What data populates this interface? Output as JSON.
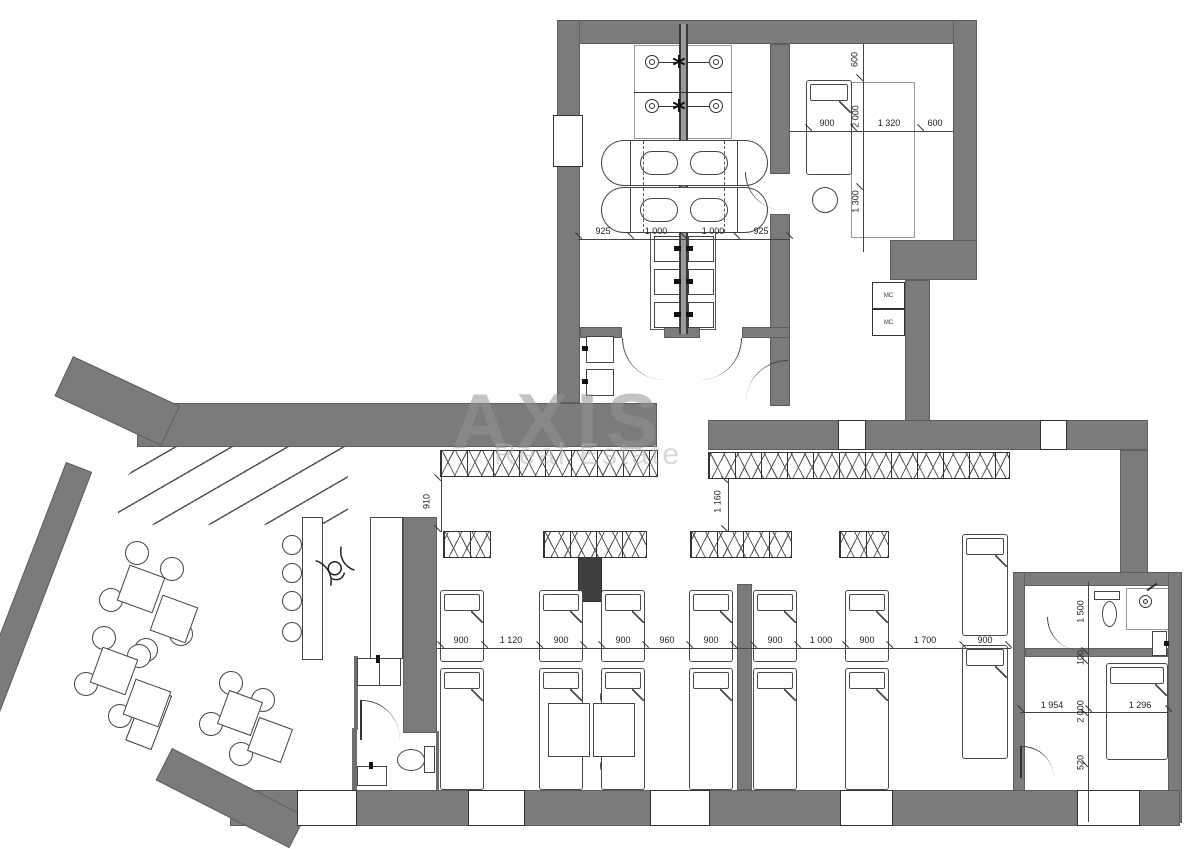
{
  "watermark": {
    "line1": "AXIS",
    "line2": "Real Estate"
  },
  "labels": {
    "mc": [
      "MC",
      "MC"
    ]
  },
  "dimensions": {
    "top_row": [
      "925",
      "1 000",
      "1 000",
      "925"
    ],
    "top_right_h": [
      "900",
      "1 320",
      "600"
    ],
    "top_right_v": [
      "600",
      "2 000",
      "1 300"
    ],
    "hall_h": [
      "900",
      "1 120",
      "900",
      "900",
      "960",
      "900",
      "900",
      "1 000",
      "900",
      "1 700",
      "900"
    ],
    "hall_v": [
      "910",
      "1 160"
    ],
    "unit_v": [
      "1 500",
      "100",
      "2 000",
      "520"
    ],
    "unit_h": [
      "1 954",
      "1 296"
    ]
  },
  "colors": {
    "wall": "#7b7b7b",
    "wall_dark": "#3f3f3f",
    "line": "#333333",
    "watermark": "#9a9a9a"
  }
}
